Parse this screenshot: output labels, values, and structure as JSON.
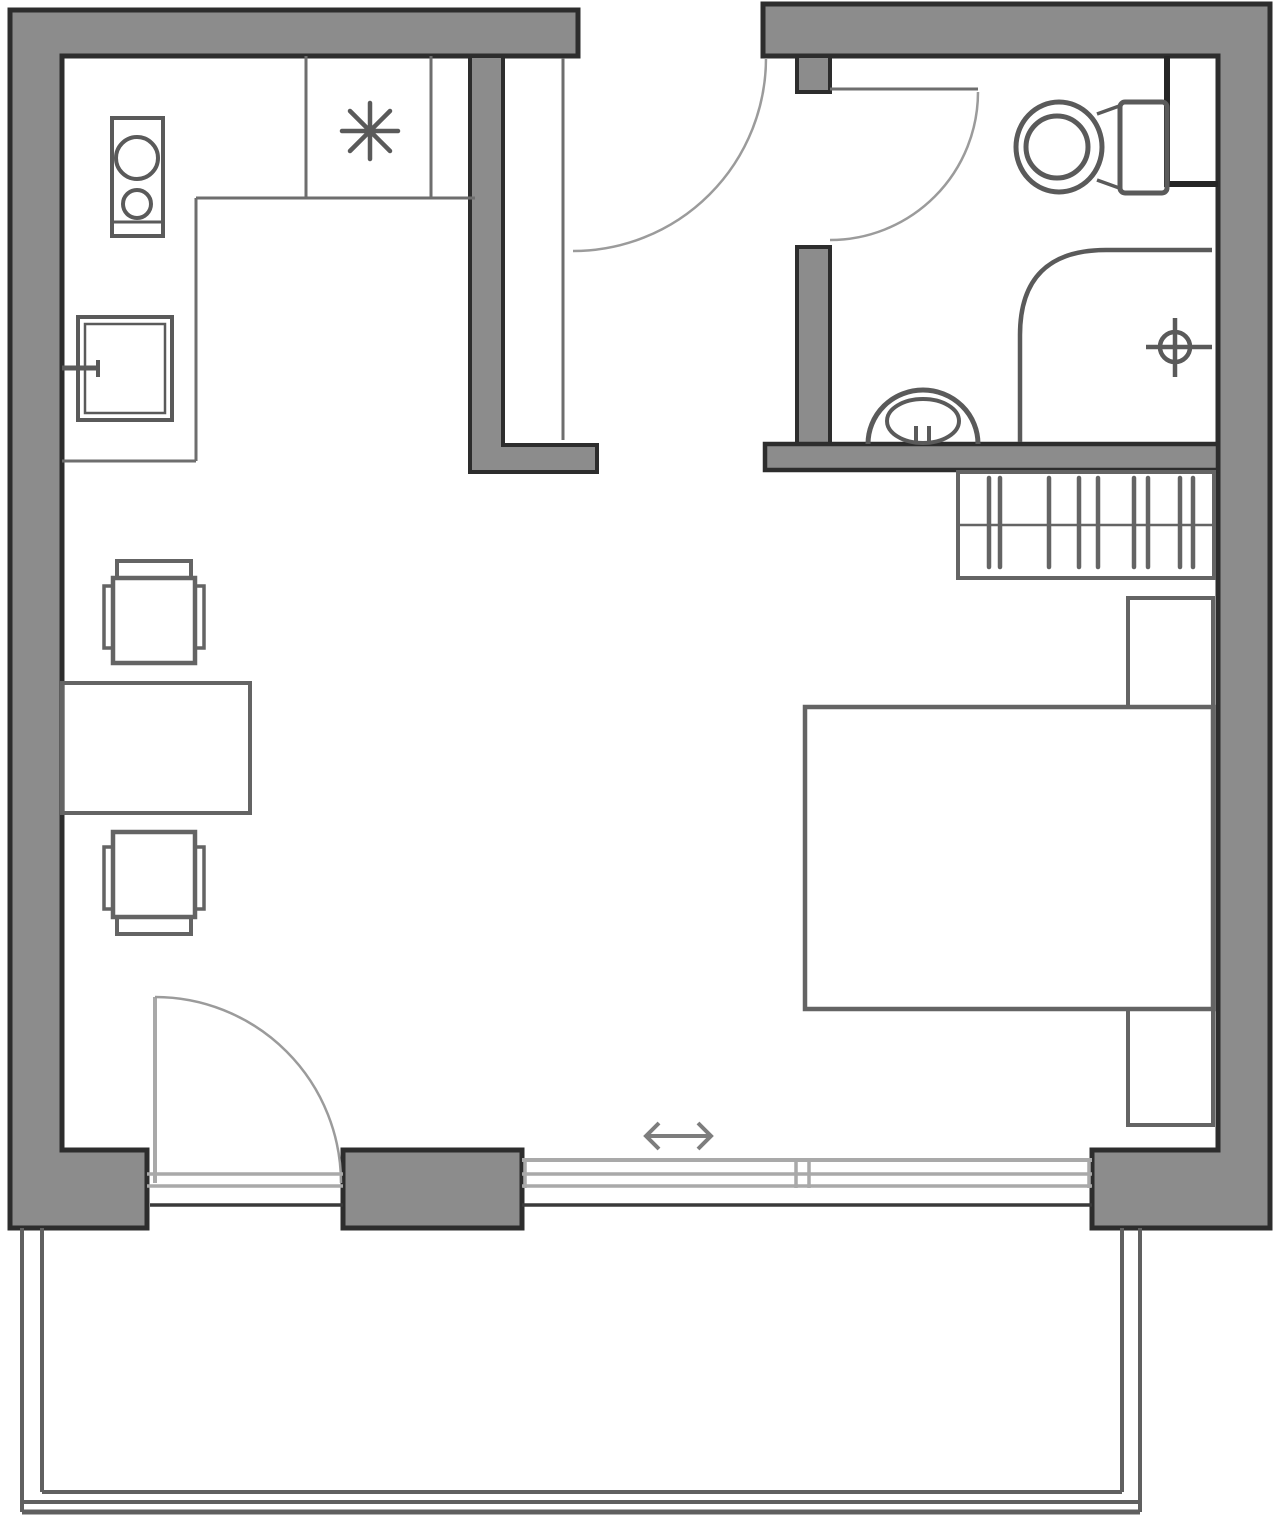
{
  "canvas": {
    "width": 1280,
    "height": 1517,
    "background": "#ffffff"
  },
  "colors": {
    "wallFill": "#8c8c8c",
    "wallStroke": "#2d2d2d",
    "fixture": "#5a5a5a",
    "furniture": "#646464",
    "counter": "#6e6e6e",
    "arc": "#9b9b9b",
    "winLight": "#a9a9a9",
    "winDark": "#3a3a3a",
    "balcony": "#606060",
    "arrow": "#7d7d7d",
    "duct": "#262626"
  },
  "plan": {
    "elements": [
      {
        "type": "path",
        "name": "wall-top-left-outline",
        "geo": [
          "M10,10 H578 V56 H62 V1150 H147 V1228 H10 Z"
        ],
        "fill": "wallFill",
        "stroke": "wallStroke",
        "sw": 5
      },
      {
        "type": "path",
        "name": "wall-right-outline",
        "geo": [
          "M763,4 H1270 V1228 H1092 V1150 H1218 V56 H763 Z"
        ],
        "fill": "wallFill",
        "stroke": "wallStroke",
        "sw": 5
      },
      {
        "type": "rect",
        "name": "wall-bathroom-partition-upper",
        "geo": [
          797,
          56,
          33,
          36
        ],
        "fill": "wallFill",
        "stroke": "wallStroke",
        "sw": 4
      },
      {
        "type": "rect",
        "name": "wall-bathroom-partition-lower",
        "geo": [
          797,
          247,
          33,
          198
        ],
        "fill": "wallFill",
        "stroke": "wallStroke",
        "sw": 4
      },
      {
        "type": "rect",
        "name": "wall-bathroom-bottom",
        "geo": [
          765,
          444,
          453,
          26
        ],
        "fill": "wallFill",
        "stroke": "wallStroke",
        "sw": 4.5
      },
      {
        "type": "path",
        "name": "wall-kitchen-partition",
        "geo": [
          "M470,56 H503 V445 H597 V472 H470 Z"
        ],
        "fill": "wallFill",
        "stroke": "wallStroke",
        "sw": 4
      },
      {
        "type": "rect",
        "name": "wall-window-pier",
        "geo": [
          343,
          1150,
          179,
          78
        ],
        "fill": "wallFill",
        "stroke": "wallStroke",
        "sw": 5
      },
      {
        "type": "path",
        "name": "utility-duct-outline",
        "geo": [
          "M1167,56 V184 H1218"
        ],
        "stroke": "duct",
        "sw": 6
      },
      {
        "type": "path",
        "name": "entry-door-arc",
        "geo": [
          "M766,58 A193,193 0 0 1 573,251"
        ],
        "stroke": "arc",
        "sw": 2.5
      },
      {
        "type": "line",
        "name": "hallway-closet-line",
        "geo": [
          563,
          58,
          563,
          440
        ],
        "stroke": "counter",
        "sw": 3
      },
      {
        "type": "line",
        "name": "bathroom-door-leaf",
        "geo": [
          830,
          89,
          978,
          89
        ],
        "stroke": "counter",
        "sw": 3
      },
      {
        "type": "path",
        "name": "bathroom-door-arc",
        "geo": [
          "M978,92 A148,148 0 0 1 830,240"
        ],
        "stroke": "arc",
        "sw": 2.5
      },
      {
        "type": "line",
        "name": "balcony-door-leaf",
        "geo": [
          155,
          997,
          155,
          1183
        ],
        "stroke": "winLight",
        "sw": 4
      },
      {
        "type": "path",
        "name": "balcony-door-arc",
        "geo": [
          "M155,997 A186,186 0 0 1 341,1183"
        ],
        "stroke": "arc",
        "sw": 2.5
      },
      {
        "type": "line",
        "name": "window-sill-left-1",
        "geo": [
          147,
          1174,
          343,
          1174
        ],
        "stroke": "winLight",
        "sw": 3.5
      },
      {
        "type": "line",
        "name": "window-sill-left-2",
        "geo": [
          147,
          1186,
          343,
          1186
        ],
        "stroke": "winLight",
        "sw": 3.5
      },
      {
        "type": "line",
        "name": "threshold-left-dark",
        "geo": [
          150,
          1205,
          343,
          1205
        ],
        "stroke": "winDark",
        "sw": 3.5
      },
      {
        "type": "line",
        "name": "window-track-1",
        "geo": [
          522,
          1160,
          1092,
          1160
        ],
        "stroke": "winLight",
        "sw": 4
      },
      {
        "type": "line",
        "name": "window-track-2",
        "geo": [
          522,
          1174,
          1092,
          1174
        ],
        "stroke": "winLight",
        "sw": 3.5
      },
      {
        "type": "line",
        "name": "window-track-3",
        "geo": [
          522,
          1186,
          1092,
          1186
        ],
        "stroke": "winLight",
        "sw": 3.5
      },
      {
        "type": "line",
        "name": "threshold-right-dark",
        "geo": [
          522,
          1205,
          1092,
          1205
        ],
        "stroke": "winDark",
        "sw": 3.5
      },
      {
        "type": "line",
        "name": "window-mullion-1",
        "geo": [
          796,
          1158,
          796,
          1188
        ],
        "stroke": "winLight",
        "sw": 3.5
      },
      {
        "type": "line",
        "name": "window-mullion-2",
        "geo": [
          809,
          1158,
          809,
          1188
        ],
        "stroke": "winLight",
        "sw": 3.5
      },
      {
        "type": "line",
        "name": "window-end-cap-left",
        "geo": [
          525,
          1158,
          525,
          1188
        ],
        "stroke": "winLight",
        "sw": 3.5
      },
      {
        "type": "line",
        "name": "window-end-cap-right",
        "geo": [
          1089,
          1158,
          1089,
          1188
        ],
        "stroke": "winLight",
        "sw": 3.5
      },
      {
        "type": "path",
        "name": "sliding-direction-arrow",
        "geo": [
          "M659,1123 L646,1136 L659,1149 M646,1136 H711 M698,1123 L711,1136 L698,1149"
        ],
        "stroke": "arrow",
        "sw": 4
      },
      {
        "type": "line",
        "name": "balcony-rail-left-outer",
        "geo": [
          22,
          1228,
          22,
          1512
        ],
        "stroke": "balcony",
        "sw": 4
      },
      {
        "type": "line",
        "name": "balcony-rail-left-inner",
        "geo": [
          42,
          1228,
          42,
          1492
        ],
        "stroke": "balcony",
        "sw": 4
      },
      {
        "type": "line",
        "name": "balcony-rail-right-inner",
        "geo": [
          1122,
          1228,
          1122,
          1492
        ],
        "stroke": "balcony",
        "sw": 4
      },
      {
        "type": "line",
        "name": "balcony-rail-right-outer",
        "geo": [
          1140,
          1228,
          1140,
          1512
        ],
        "stroke": "balcony",
        "sw": 4
      },
      {
        "type": "line",
        "name": "balcony-edge-inner",
        "geo": [
          42,
          1492,
          1122,
          1492
        ],
        "stroke": "balcony",
        "sw": 4
      },
      {
        "type": "line",
        "name": "balcony-edge-middle",
        "geo": [
          22,
          1502,
          1140,
          1502
        ],
        "stroke": "balcony",
        "sw": 4
      },
      {
        "type": "line",
        "name": "balcony-edge-outer",
        "geo": [
          22,
          1512,
          1140,
          1512
        ],
        "stroke": "balcony",
        "sw": 5
      },
      {
        "type": "line",
        "name": "kitchen-counter-front",
        "geo": [
          196,
          198,
          475,
          198
        ],
        "stroke": "counter",
        "sw": 3
      },
      {
        "type": "line",
        "name": "kitchen-counter-side",
        "geo": [
          196,
          198,
          196,
          461
        ],
        "stroke": "counter",
        "sw": 3
      },
      {
        "type": "line",
        "name": "kitchen-counter-end",
        "geo": [
          62,
          461,
          196,
          461
        ],
        "stroke": "counter",
        "sw": 3
      },
      {
        "type": "line",
        "name": "kitchen-cabinet-divider-1",
        "geo": [
          306,
          56,
          306,
          198
        ],
        "stroke": "counter",
        "sw": 3
      },
      {
        "type": "line",
        "name": "kitchen-cabinet-divider-2",
        "geo": [
          431,
          56,
          431,
          198
        ],
        "stroke": "counter",
        "sw": 3
      },
      {
        "type": "path",
        "name": "kitchen-appliance-asterisk-symbol",
        "geo": [
          "M342,131 H398 M370,103 V159 M350,111 L390,151 M390,111 L350,151"
        ],
        "stroke": "fixture",
        "sw": 4.5,
        "cap": "round"
      },
      {
        "type": "rect",
        "name": "stove-outline",
        "geo": [
          112,
          118,
          51,
          118
        ],
        "stroke": "fixture",
        "sw": 4
      },
      {
        "type": "line",
        "name": "stove-front-line",
        "geo": [
          112,
          222,
          163,
          222
        ],
        "stroke": "fixture",
        "sw": 3
      },
      {
        "type": "circle",
        "name": "stove-burner-large",
        "geo": [
          137,
          158,
          21
        ],
        "stroke": "fixture",
        "sw": 4
      },
      {
        "type": "circle",
        "name": "stove-burner-small",
        "geo": [
          137,
          204,
          14
        ],
        "stroke": "fixture",
        "sw": 4
      },
      {
        "type": "rect",
        "name": "kitchen-sink-outer",
        "geo": [
          78,
          317,
          94,
          103
        ],
        "stroke": "fixture",
        "sw": 4
      },
      {
        "type": "rect",
        "name": "kitchen-sink-inner",
        "geo": [
          85,
          324,
          80,
          89
        ],
        "stroke": "fixture",
        "sw": 2.5
      },
      {
        "type": "line",
        "name": "kitchen-faucet",
        "geo": [
          62,
          368,
          100,
          368
        ],
        "stroke": "fixture",
        "sw": 5
      },
      {
        "type": "line",
        "name": "kitchen-faucet-handle",
        "geo": [
          98,
          360,
          98,
          377
        ],
        "stroke": "fixture",
        "sw": 4
      },
      {
        "type": "ellipse",
        "name": "toilet-bowl-outer",
        "geo": [
          1059,
          147,
          43,
          45
        ],
        "stroke": "fixture",
        "sw": 5
      },
      {
        "type": "circle",
        "name": "toilet-bowl-inner",
        "geo": [
          1057,
          147,
          31
        ],
        "stroke": "fixture",
        "sw": 5
      },
      {
        "type": "rect",
        "name": "toilet-tank",
        "geo": [
          1120,
          102,
          47,
          91,
          5
        ],
        "stroke": "fixture",
        "sw": 5
      },
      {
        "type": "line",
        "name": "toilet-join-top",
        "geo": [
          1097,
          114,
          1122,
          105
        ],
        "stroke": "fixture",
        "sw": 3.5
      },
      {
        "type": "line",
        "name": "toilet-join-bottom",
        "geo": [
          1097,
          180,
          1122,
          189
        ],
        "stroke": "fixture",
        "sw": 3.5
      },
      {
        "type": "path",
        "name": "bathroom-sink-bowl",
        "geo": [
          "M868,444 A55,54 0 0 1 978,444"
        ],
        "stroke": "fixture",
        "sw": 5
      },
      {
        "type": "ellipse",
        "name": "bathroom-sink-basin",
        "geo": [
          923,
          421,
          36,
          22
        ],
        "stroke": "fixture",
        "sw": 4
      },
      {
        "type": "line",
        "name": "bathroom-faucet-1",
        "geo": [
          916,
          426,
          916,
          441
        ],
        "stroke": "fixture",
        "sw": 4
      },
      {
        "type": "line",
        "name": "bathroom-faucet-2",
        "geo": [
          929,
          426,
          929,
          441
        ],
        "stroke": "fixture",
        "sw": 4
      },
      {
        "type": "path",
        "name": "shower-enclosure",
        "geo": [
          "M1020,442 V335 Q1020,250 1106,250 H1212"
        ],
        "stroke": "fixture",
        "sw": 4.5
      },
      {
        "type": "circle",
        "name": "shower-drain-ring",
        "geo": [
          1175,
          347,
          15
        ],
        "stroke": "fixture",
        "sw": 4.5
      },
      {
        "type": "line",
        "name": "shower-drain-horizontal",
        "geo": [
          1146,
          347,
          1212,
          347
        ],
        "stroke": "fixture",
        "sw": 4.5
      },
      {
        "type": "line",
        "name": "shower-drain-vertical",
        "geo": [
          1175,
          318,
          1175,
          377
        ],
        "stroke": "fixture",
        "sw": 4.5
      },
      {
        "type": "rect",
        "name": "dining-table",
        "geo": [
          62,
          683,
          188,
          130
        ],
        "stroke": "furniture",
        "sw": 4
      },
      {
        "type": "rect",
        "name": "chair-top-back",
        "geo": [
          117,
          561,
          74,
          17
        ],
        "stroke": "furniture",
        "sw": 4
      },
      {
        "type": "rect",
        "name": "chair-top-seat",
        "geo": [
          113,
          578,
          82,
          85
        ],
        "stroke": "furniture",
        "sw": 4.5
      },
      {
        "type": "rect",
        "name": "chair-top-arm-left",
        "geo": [
          104,
          586,
          9,
          62
        ],
        "stroke": "furniture",
        "sw": 3.5
      },
      {
        "type": "rect",
        "name": "chair-top-arm-right",
        "geo": [
          195,
          586,
          9,
          62
        ],
        "stroke": "furniture",
        "sw": 3.5
      },
      {
        "type": "rect",
        "name": "chair-bottom-seat",
        "geo": [
          113,
          832,
          82,
          85
        ],
        "stroke": "furniture",
        "sw": 4.5
      },
      {
        "type": "rect",
        "name": "chair-bottom-back",
        "geo": [
          117,
          917,
          74,
          17
        ],
        "stroke": "furniture",
        "sw": 4
      },
      {
        "type": "rect",
        "name": "chair-bottom-arm-left",
        "geo": [
          104,
          847,
          9,
          62
        ],
        "stroke": "furniture",
        "sw": 3.5
      },
      {
        "type": "rect",
        "name": "chair-bottom-arm-right",
        "geo": [
          195,
          847,
          9,
          62
        ],
        "stroke": "furniture",
        "sw": 3.5
      },
      {
        "type": "rect",
        "name": "bed",
        "geo": [
          805,
          707,
          408,
          302
        ],
        "stroke": "furniture",
        "sw": 4.5
      },
      {
        "type": "rect",
        "name": "nightstand-top",
        "geo": [
          1128,
          598,
          85,
          109
        ],
        "stroke": "furniture",
        "sw": 4
      },
      {
        "type": "rect",
        "name": "nightstand-bottom",
        "geo": [
          1128,
          1009,
          85,
          116
        ],
        "stroke": "furniture",
        "sw": 4
      },
      {
        "type": "rect",
        "name": "wardrobe",
        "geo": [
          958,
          472,
          256,
          106
        ],
        "stroke": "furniture",
        "sw": 4
      },
      {
        "type": "line",
        "name": "wardrobe-rail",
        "geo": [
          958,
          525,
          1214,
          525
        ],
        "stroke": "furniture",
        "sw": 2.5
      },
      {
        "type": "line",
        "name": "wardrobe-hanger-1",
        "geo": [
          989,
          478,
          989,
          567
        ],
        "stroke": "furniture",
        "sw": 4.5,
        "cap": "round"
      },
      {
        "type": "line",
        "name": "wardrobe-hanger-2",
        "geo": [
          1000,
          478,
          1000,
          567
        ],
        "stroke": "furniture",
        "sw": 4.5,
        "cap": "round"
      },
      {
        "type": "line",
        "name": "wardrobe-hanger-3",
        "geo": [
          1049,
          478,
          1049,
          567
        ],
        "stroke": "furniture",
        "sw": 4.5,
        "cap": "round"
      },
      {
        "type": "line",
        "name": "wardrobe-hanger-4",
        "geo": [
          1079,
          478,
          1079,
          567
        ],
        "stroke": "furniture",
        "sw": 4.5,
        "cap": "round"
      },
      {
        "type": "line",
        "name": "wardrobe-hanger-5",
        "geo": [
          1098,
          478,
          1098,
          567
        ],
        "stroke": "furniture",
        "sw": 4.5,
        "cap": "round"
      },
      {
        "type": "line",
        "name": "wardrobe-hanger-6",
        "geo": [
          1134,
          478,
          1134,
          567
        ],
        "stroke": "furniture",
        "sw": 4.5,
        "cap": "round"
      },
      {
        "type": "line",
        "name": "wardrobe-hanger-7",
        "geo": [
          1148,
          478,
          1148,
          567
        ],
        "stroke": "furniture",
        "sw": 4.5,
        "cap": "round"
      },
      {
        "type": "line",
        "name": "wardrobe-hanger-8",
        "geo": [
          1180,
          478,
          1180,
          567
        ],
        "stroke": "furniture",
        "sw": 4.5,
        "cap": "round"
      },
      {
        "type": "line",
        "name": "wardrobe-hanger-9",
        "geo": [
          1193,
          478,
          1193,
          567
        ],
        "stroke": "furniture",
        "sw": 4.5,
        "cap": "round"
      }
    ]
  }
}
